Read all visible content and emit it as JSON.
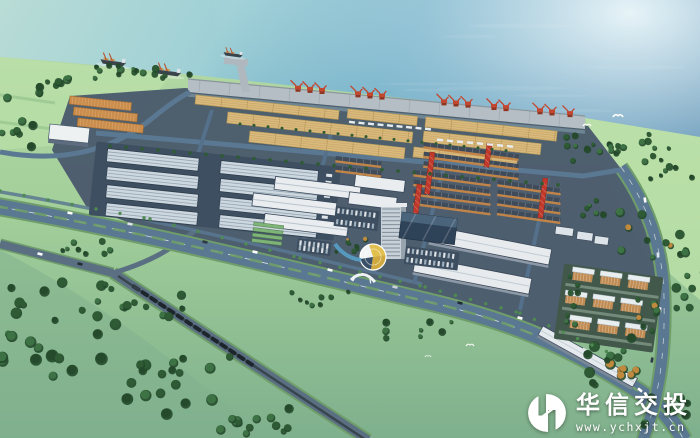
{
  "watermark": {
    "brand": "华信交投",
    "url": "www.ychxjt.cn",
    "logo": "hx-circle-monogram"
  },
  "scene": {
    "type": "aerial architectural rendering",
    "subject": "seaport logistics and industrial park master plan",
    "elements": [
      "sea",
      "cargo ships",
      "wharf with red portal cranes",
      "pier",
      "bulk storage yards",
      "warehouse complex",
      "trade halls",
      "workshop blocks with red gantry cranes",
      "office tower",
      "entrance plaza with yellow fan",
      "white logistics sheds",
      "residential quarter",
      "freight railway with train",
      "arterial road with green median",
      "green fields",
      "tree belts",
      "seagulls"
    ]
  },
  "palette": {
    "sea_light": "#b9dcd6",
    "sea_mid": "#58a0bd",
    "sea_deep": "#2e6f9b",
    "haze": "#f0fafc",
    "grass": "#a8d49c",
    "grass_dark": "#7fb08d",
    "grass_bright": "#bfe3ab",
    "tree_dark": "#24492b",
    "tree": "#2e5a34",
    "tree_light": "#3d7344",
    "tree_autumn": "#c08a3e",
    "pavement": "#4a5a6c",
    "road": "#5b7892",
    "road_verge": "#6f9e6a",
    "quay": "#b4bec4",
    "yard": "#d9ba7c",
    "yard_line": "#b79a55",
    "crane_red": "#c2472e",
    "gantry_red": "#c0392b",
    "roof_light": "#cdd7df",
    "roof_white": "#e9edf0",
    "roof_edge": "#39485a",
    "roof_stripe": "#93a5b2",
    "wall_orange": "#c08449",
    "workshop_roof": "#3f4b59",
    "shed_orange": "#cb8d4b",
    "tower": "#c8d1d8",
    "tower_side": "#97a4ae",
    "podium": "#2f4358",
    "rail": "#39454e",
    "corridor": "#5a7082",
    "train": "#1e262d",
    "hull": "#3b434c",
    "bridge_white": "#dde3e7",
    "cargo_tan": "#c49a5e",
    "plaza_yellow": "#e2c050",
    "pool_blue": "#58a0c8",
    "residential_wall": "#c08c54",
    "residential_roof": "#e8edf0",
    "white": "#ffffff"
  }
}
